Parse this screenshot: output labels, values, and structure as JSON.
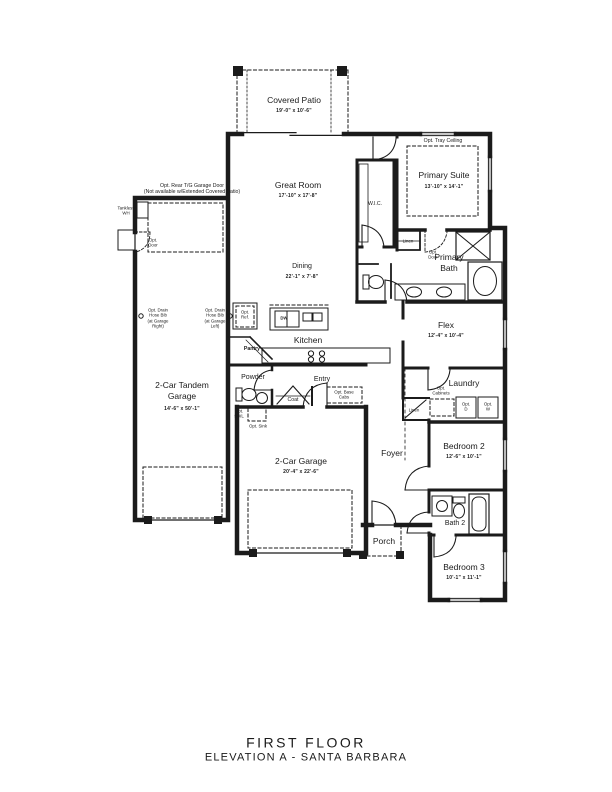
{
  "title": {
    "line1": "FIRST FLOOR",
    "line2": "ELEVATION A - SANTA BARBARA"
  },
  "rooms": {
    "covered_patio": {
      "name": "Covered Patio",
      "dims": "19'-0\" x 10'-6\""
    },
    "great_room": {
      "name": "Great Room",
      "dims": "17'-10\" x 17'-8\""
    },
    "primary_suite": {
      "name": "Primary Suite",
      "dims": "13'-10\" x 14'-1\""
    },
    "wic": {
      "name": "W.I.C."
    },
    "primary_bath": {
      "name": "Primary Bath"
    },
    "dining": {
      "name": "Dining",
      "dims": "22'-1\" x 7'-8\""
    },
    "kitchen": {
      "name": "Kitchen"
    },
    "pantry": {
      "name": "Pantry"
    },
    "powder": {
      "name": "Powder"
    },
    "entry": {
      "name": "Entry"
    },
    "coat": {
      "name": "Coat"
    },
    "flex": {
      "name": "Flex",
      "dims": "12'-4\" x 10'-4\""
    },
    "laundry": {
      "name": "Laundry"
    },
    "foyer": {
      "name": "Foyer"
    },
    "porch": {
      "name": "Porch"
    },
    "bedroom2": {
      "name": "Bedroom 2",
      "dims": "12'-6\" x 10'-1\""
    },
    "bath2": {
      "name": "Bath 2"
    },
    "bedroom3": {
      "name": "Bedroom 3",
      "dims": "10'-1\" x 11'-1\""
    },
    "tandem_garage": {
      "name": "2-Car Tandem Garage",
      "dims": "14'-6\" x 50'-1\""
    },
    "garage": {
      "name": "2-Car Garage",
      "dims": "20'-4\" x 22'-6\""
    }
  },
  "annotations": {
    "opt_tray_ceiling": "Opt. Tray Ceiling",
    "opt_rear_garage_door": [
      "Opt. Rear T/G Garage Door",
      "(Not available w/Extended Covered Patio)"
    ],
    "tankless_wh": [
      "Tankless",
      "WH"
    ],
    "opt_door_wh": [
      "Opt.",
      "Door"
    ],
    "opt_door_primary": [
      "Opt.",
      "Door"
    ],
    "linen_primary": "Linen",
    "linen_hall": "Linen",
    "opt_ref": [
      "Opt.",
      "Ref."
    ],
    "dw": "DW",
    "opt_cabinets": [
      "Opt.",
      "Cabinets"
    ],
    "opt_dryer": [
      "Opt.",
      "D"
    ],
    "opt_washer": [
      "Opt.",
      "W"
    ],
    "opt_base_cabs": [
      "Opt. Base",
      "Cabs"
    ],
    "opt_swl": [
      "Opt.",
      "SWL"
    ],
    "opt_sink": "Opt. Sink",
    "drain_right": [
      "Opt. Drain",
      "Hose Bib",
      "(at Garage",
      "Right)"
    ],
    "drain_left": [
      "Opt. Drain",
      "Hose Bib",
      "(at Garage",
      "Left)"
    ]
  },
  "colors": {
    "ink": "#1b1b1b",
    "paper": "#ffffff"
  }
}
